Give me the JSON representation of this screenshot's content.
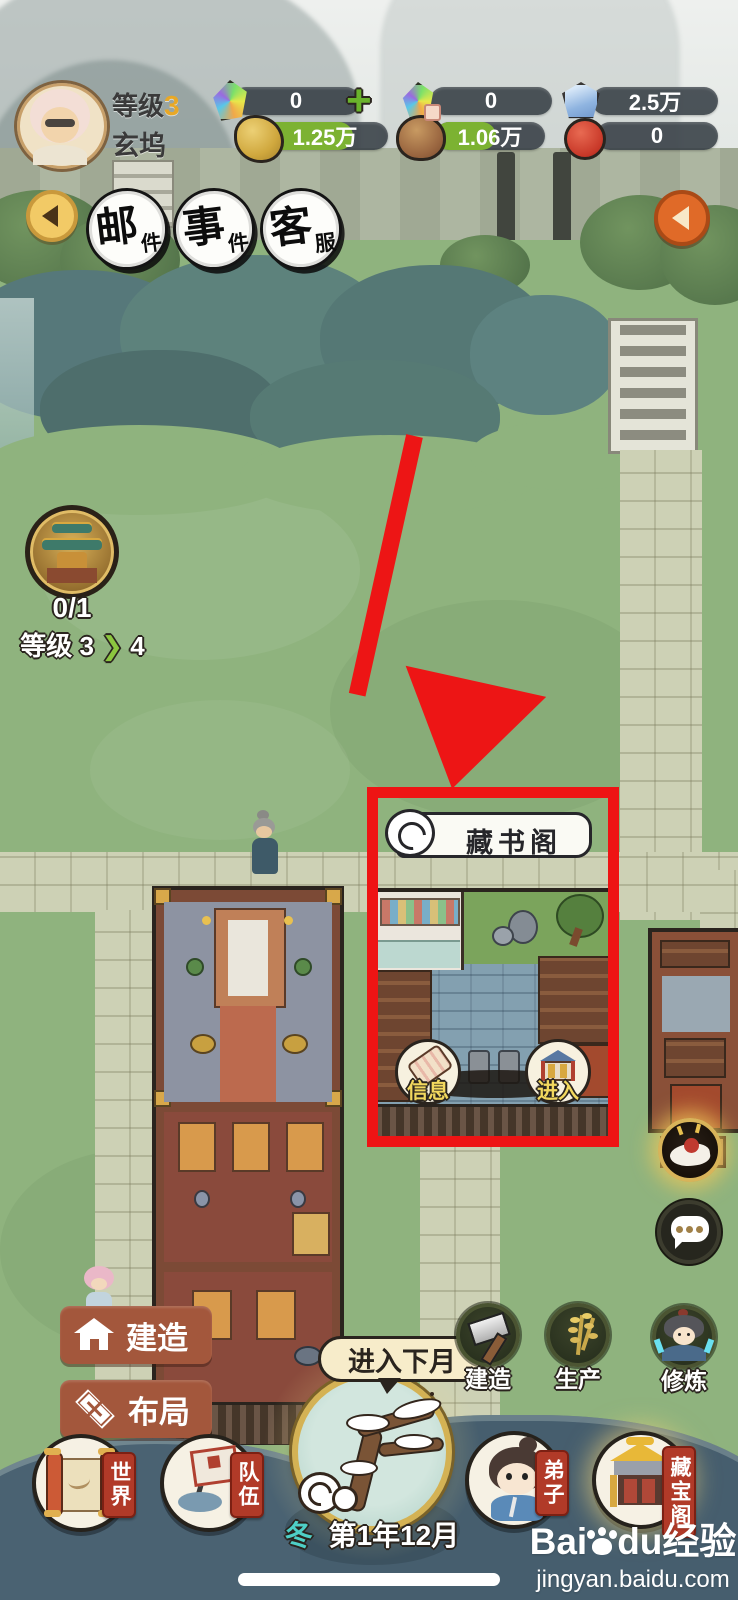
{
  "player": {
    "level_label": "等级",
    "level": "3",
    "name": "玄坞"
  },
  "currencies": {
    "gem": "0",
    "plus": "+",
    "gem_locked": "0",
    "crystal": "2.5万",
    "gold": "1.25万",
    "wood": "1.06万",
    "seal": "0"
  },
  "top_buttons": {
    "mail_main": "邮",
    "mail_sub": "件",
    "event_main": "事",
    "event_sub": "件",
    "service_main": "客",
    "service_sub": "服"
  },
  "upgrade_badge": {
    "count": "0/1",
    "level_label": "等级",
    "from": "3",
    "arrow": "❯",
    "to": "4"
  },
  "building": {
    "name": "藏书阁",
    "info_label": "信息",
    "enter_label": "进入"
  },
  "left_actions": {
    "build": "建造",
    "layout": "布局"
  },
  "right_actions": {
    "build": "建造",
    "produce": "生产",
    "cultivate": "修炼"
  },
  "bottom_nav": {
    "world": "世界",
    "team": "队伍",
    "disciple": "弟子",
    "treasure": "藏宝阁"
  },
  "month": {
    "bubble": "进入下月",
    "season": "冬",
    "date": "第1年12月"
  },
  "watermark": {
    "logo_prefix": "Bai",
    "logo_suffix": "du",
    "logo_cn": "经验",
    "url": "jingyan.baidu.com"
  },
  "colors": {
    "highlight_red": "#ee1414",
    "badge_red": "#b13a28",
    "button_brown": "#a3573c",
    "fill_green": "#7cb232",
    "season_teal": "#4ecfc6",
    "gold_ring": "#d4b254"
  }
}
